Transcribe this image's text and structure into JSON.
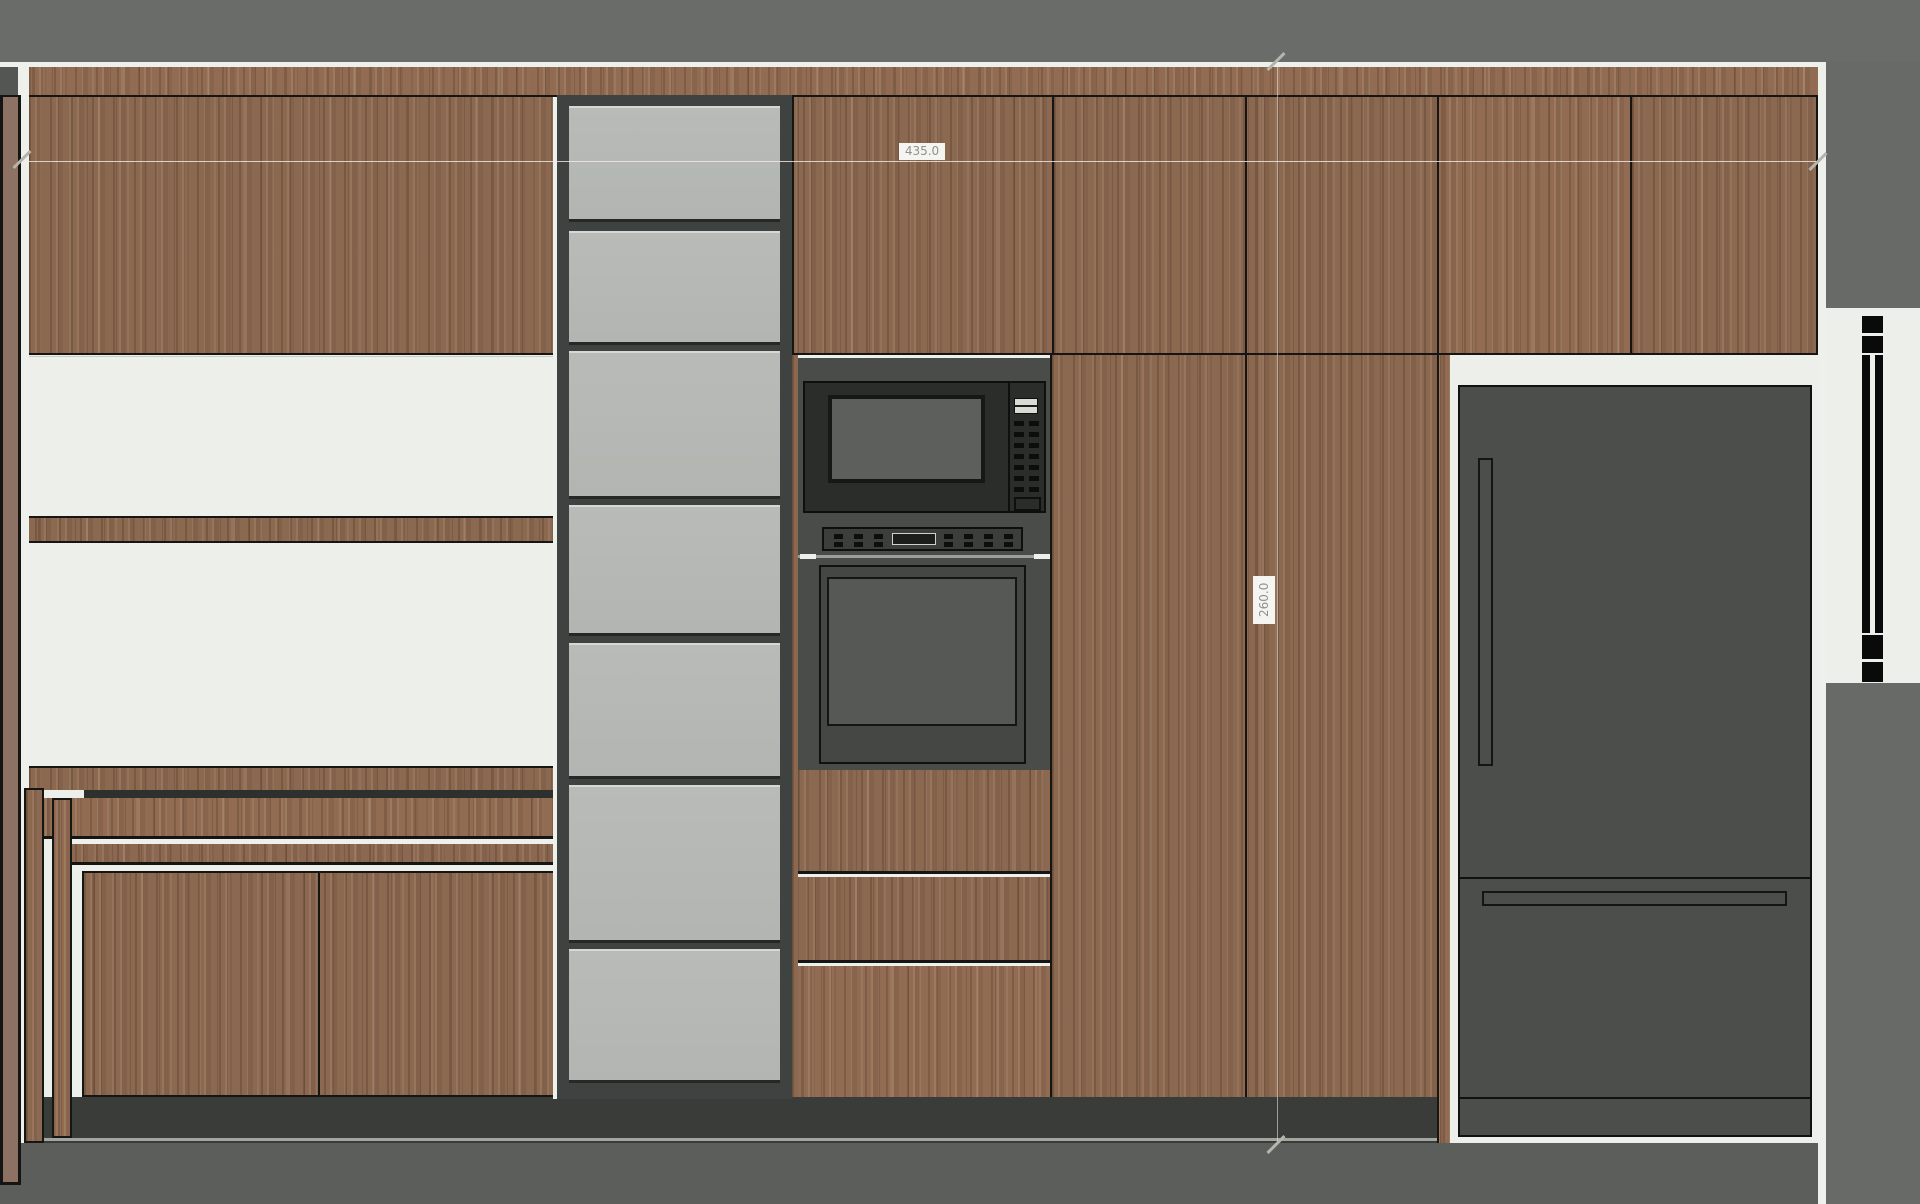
{
  "drawing": {
    "type": "kitchen cabinetry elevation",
    "dim_width_label": "435.0",
    "dim_height_label": "260.0"
  },
  "palette": {
    "top_band": "#6a6c69",
    "floor": "#5c5e5b",
    "right_panel": "#686a67",
    "plinth": "#3a3c3a",
    "wood_base": "#8b6850",
    "line_dark": "#151513",
    "wall_strip": "#8d7162",
    "white_panel": "#edefeb",
    "glass": "#b8bbb7",
    "glass_frame": "#3e4240",
    "niche": "#4a4c4a",
    "appliance": "#2b2d2b",
    "appliance_panel": "#3c3e3c",
    "oven_door": "#454745",
    "screen": "#5d5f5d",
    "fridge": "#4c4e4c",
    "display_light": "#d9dcd5",
    "steel": "#9b9e99",
    "hairline": "#eef0ec",
    "dim_tick": "#b7b4ac",
    "dim_text": "#8f928c",
    "label_bg": "#f4f5f1",
    "corner_block": "#545653"
  },
  "glass_column": {
    "panels": [
      {
        "top": 106,
        "bottom": 222
      },
      {
        "top": 231,
        "bottom": 345
      },
      {
        "top": 351,
        "bottom": 499
      },
      {
        "top": 505,
        "bottom": 636
      },
      {
        "top": 643,
        "bottom": 779
      },
      {
        "top": 785,
        "bottom": 943
      },
      {
        "top": 949,
        "bottom": 1083
      }
    ]
  }
}
